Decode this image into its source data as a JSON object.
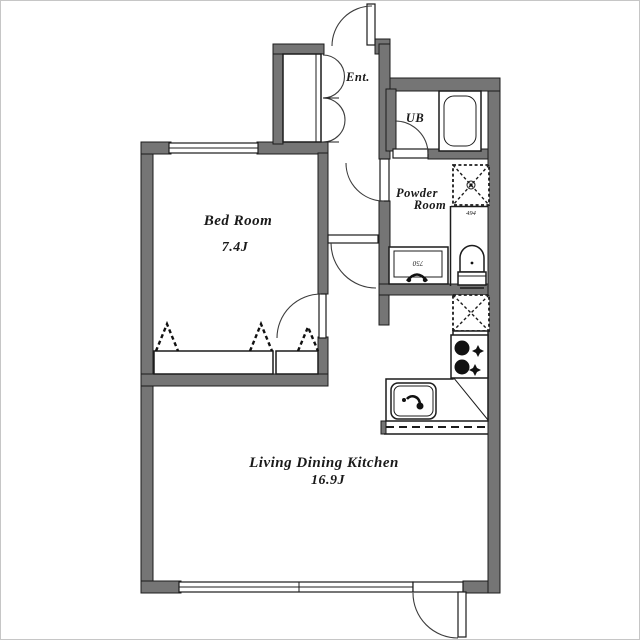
{
  "document_type": "apartment floor plan",
  "rooms": {
    "bedroom": {
      "name": "Bed Room",
      "area": "7.4J"
    },
    "ldk": {
      "name": "Living Dining Kitchen",
      "area": "16.9J"
    },
    "entrance": {
      "name": "Ent."
    },
    "unit_bath": {
      "name": "UB"
    },
    "powder_room": {
      "name_line1": "Powder",
      "name_line2": "Room"
    }
  },
  "dimensions": {
    "vanity_width": "750",
    "toilet_nook_depth": "494"
  },
  "colors": {
    "wall": "#757575",
    "line": "#1c1c1c",
    "floor": "#ffffff",
    "frame_border": "#c6c6c6"
  },
  "fixtures": [
    "bathtub",
    "washing-machine-space",
    "refrigerator-space",
    "toilet",
    "vanity",
    "kitchen-sink",
    "stove",
    "shoe-cabinet",
    "closet-hanger-symbols",
    "windows",
    "swing-doors"
  ]
}
